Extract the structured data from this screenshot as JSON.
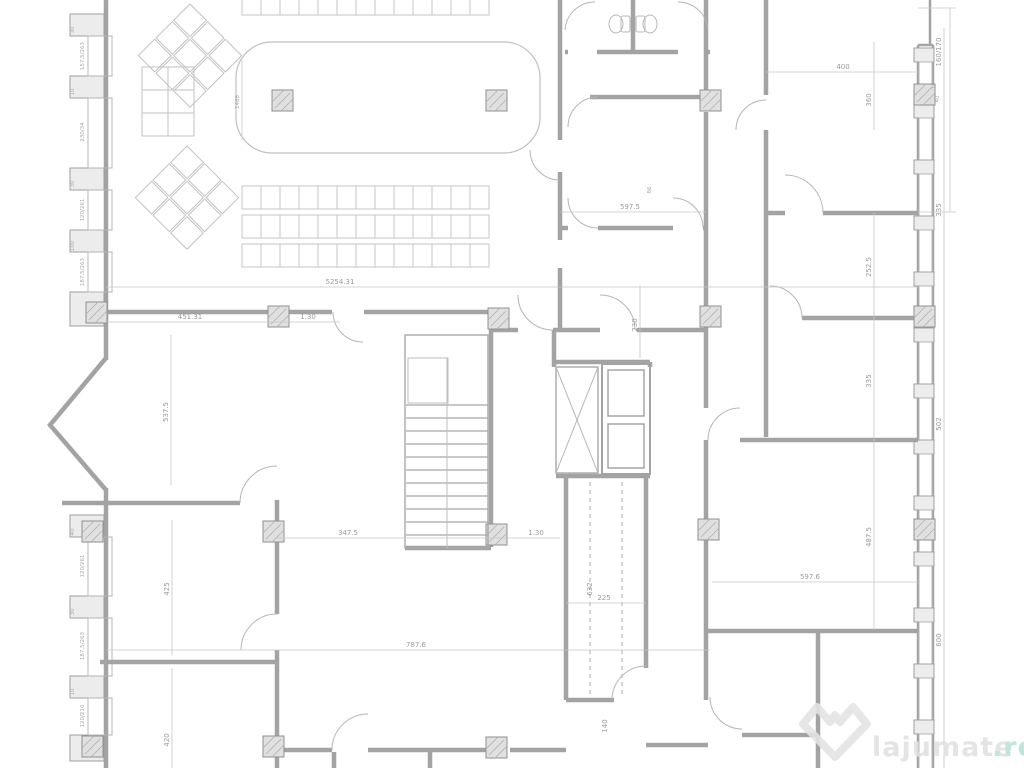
{
  "plan": {
    "watermark": {
      "brand": "lajumate",
      "tld": ".ro"
    },
    "colors": {
      "wall": "#a3a3a3",
      "thin_line": "#c4c4c4",
      "dimension_line": "#bdbdbd",
      "label_text": "#9b9b9b",
      "column_fill": "#e0e0e0",
      "watermark_gray": "#e4e4e4",
      "watermark_teal": "#b7e3db"
    },
    "dimensions": {
      "total_width": "5254.31",
      "room_a_width": "451.31",
      "door_a": "1.30",
      "room_a_height": "537.5",
      "stair_width": "347.5",
      "door_b": "1.30",
      "hall_width": "787.6",
      "room_b_width": "597.6",
      "room_c_width": "400",
      "room_c_height": "360",
      "wc_width": "597.5",
      "wc_note": "86",
      "corridor_width": "230",
      "shaft_height": "632",
      "shaft_width": "225",
      "door_c": "140",
      "room_d_height": "425",
      "room_e_height": "420",
      "table_length": "1488",
      "seg_1": "252.5",
      "seg_2": "335",
      "seg_3": "487.5",
      "out_top": "160/170",
      "out_1": "335",
      "out_2": "502",
      "out_3": "600",
      "tick_a": "16",
      "tick_b": "40"
    },
    "left_wall": {
      "window_labels": [
        "157,5/263",
        "230/34",
        "120/261",
        "187,5/263",
        "120/261",
        "187,5/263",
        "120/210"
      ],
      "tick_labels": [
        "30",
        "10",
        "30",
        "100",
        "40",
        "30",
        "10"
      ]
    }
  }
}
